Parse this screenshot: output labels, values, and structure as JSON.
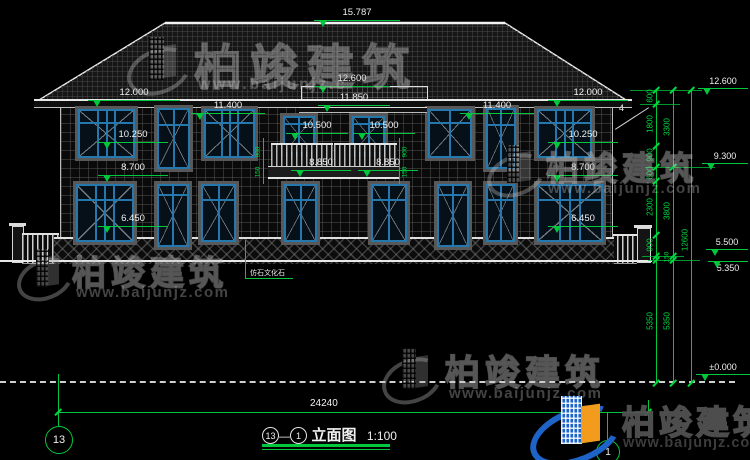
{
  "watermark": {
    "brand": "柏竣建筑",
    "url": "www.baijunjz.com",
    "url_short": "www.baijunjz.c"
  },
  "title": {
    "bubble_left": "13",
    "dash": "—",
    "bubble_right": "1",
    "name": "立面图",
    "scale": "1:100"
  },
  "grid": {
    "left_bubble": "13",
    "right_bubble": "1"
  },
  "callout": {
    "text": "仿石文化石"
  },
  "roof": {
    "slope": "4"
  },
  "overall_dim": "24240",
  "elevations": [
    "15.787",
    "12.600",
    "11.850",
    "12.000",
    "12.000",
    "11.400",
    "11.400",
    "10.500",
    "10.500",
    "10.250",
    "10.250",
    "8.850",
    "8.850",
    "8.700",
    "8.700",
    "6.450",
    "6.450",
    "12.600",
    "9.300",
    "5.500",
    "5.350",
    "±0.000"
  ],
  "chains": {
    "c1": [
      "600",
      "1800",
      "900",
      "600",
      "2300",
      "900",
      "5350"
    ],
    "c2": [
      "3300",
      "3800",
      "150",
      "5350"
    ],
    "c3": [
      "12600"
    ]
  },
  "balcony_dims": {
    "left": [
      "900",
      "150"
    ],
    "right": [
      "900",
      "150"
    ]
  },
  "colors": {
    "annotation": "#00c83c",
    "window_frame": "#2478ad",
    "logo_blue": "#1e63c8",
    "logo_orange": "#f39b1d"
  }
}
